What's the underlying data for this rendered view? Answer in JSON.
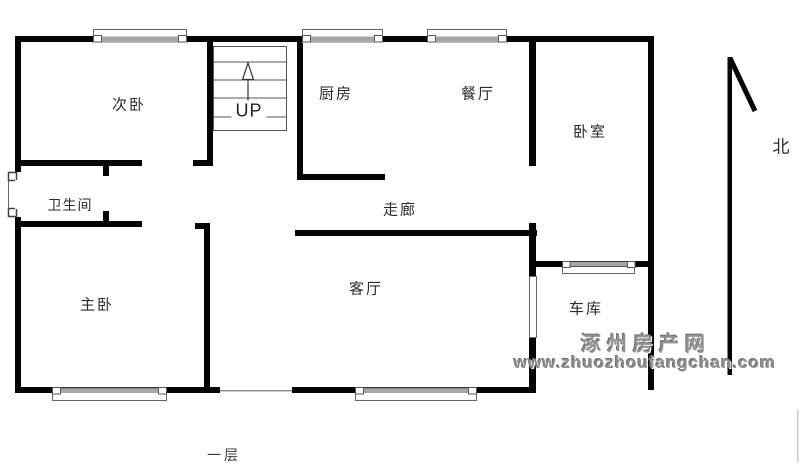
{
  "floor_plan": {
    "rooms": {
      "secondary_bedroom": "次卧",
      "kitchen": "厨房",
      "dining_room": "餐厅",
      "bedroom": "卧室",
      "bathroom": "卫生间",
      "corridor": "走廊",
      "master_bedroom": "主卧",
      "living_room": "客厅",
      "garage": "车库"
    },
    "stairs_label": "UP",
    "north_label": "北",
    "floor_label": "一层",
    "watermark": {
      "site_name": "涿州房产网",
      "site_url": "www.zhuozhoufangchan.com",
      "color": "#8d8d8d"
    },
    "colors": {
      "wall": "#050505",
      "window_bar": "#a6a6a6",
      "thin_line": "#666666",
      "label_text": "#2b2b2b",
      "background": "#ffffff"
    }
  }
}
